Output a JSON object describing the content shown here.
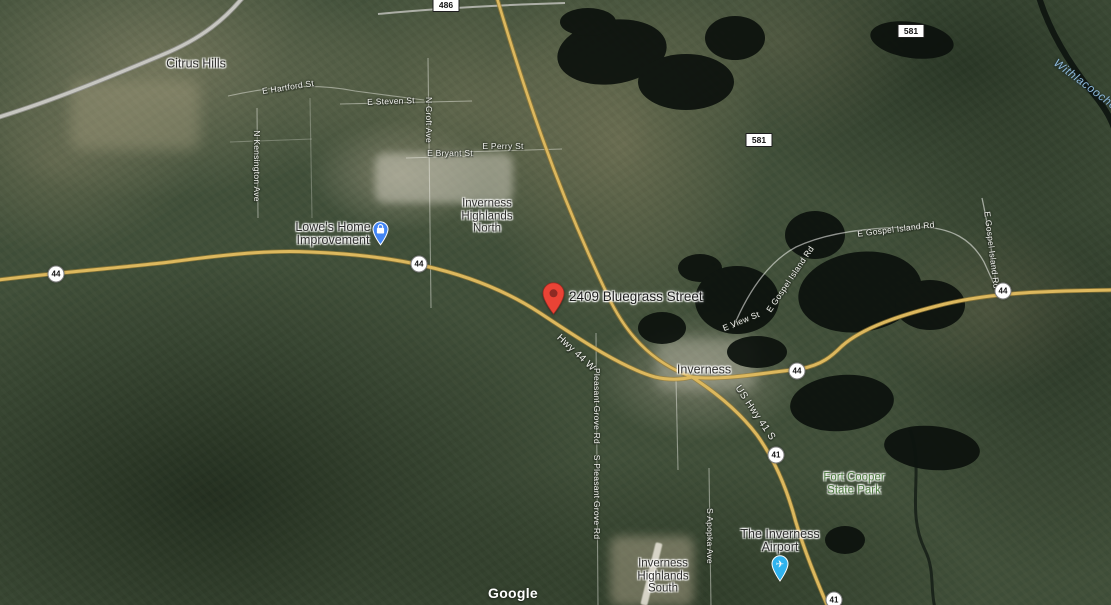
{
  "marker": {
    "title": "2409 Bluegrass Street",
    "icon": "red-map-pin-icon",
    "color": "#EA4335"
  },
  "places": {
    "citrus_hills": {
      "label": "Citrus Hills"
    },
    "inverness_highlands_north": {
      "line1": "Inverness",
      "line2": "Highlands",
      "line3": "North"
    },
    "inverness": {
      "label": "Inverness"
    },
    "inverness_highlands_south": {
      "line1": "Inverness",
      "line2": "Highlands",
      "line3": "South"
    },
    "fort_cooper": {
      "line1": "Fort Cooper",
      "line2": "State Park",
      "color": "#4C7C3F"
    }
  },
  "pois": {
    "lowes": {
      "line1": "Lowe's Home",
      "line2": "Improvement",
      "icon": "shopping-bag-pin-icon",
      "color": "#4285F4"
    },
    "airport": {
      "line1": "The Inverness",
      "line2": "Airport",
      "icon": "airplane-pin-icon",
      "color": "#2FB3EF"
    }
  },
  "streets": {
    "e_hartford": "E Hartford St",
    "e_steven": "E Steven St",
    "n_croft": "N Croft Ave",
    "e_bryant": "E Bryant St",
    "e_perry": "E Perry St",
    "n_kensington": "N Kensington Ave",
    "hwy_44_w": "Hwy 44 W",
    "us_hwy_41_s": "US Hwy 41 S",
    "pleasant_grove": "Pleasant Grove Rd",
    "s_pleasant_grove": "S Pleasant Grove Rd",
    "s_apopka": "S Apopka Ave",
    "e_view": "E View St",
    "e_gospel_island_a": "E Gospel Island Rd",
    "e_gospel_island_b": "E Gospel Island Rd",
    "e_gospel_island_c": "E Gospel Island Rd"
  },
  "water": {
    "withlacoochee": "Withlacoochee"
  },
  "shields": {
    "s486": "486",
    "s581a": "581",
    "s581b": "581",
    "c44a": "44",
    "c44b": "44",
    "c44c": "44",
    "c44d": "44",
    "c41a": "41",
    "c41b": "41"
  },
  "attribution": {
    "logo": "Google"
  },
  "colors": {
    "highway_road": "#DCB85E",
    "minor_road": "#C6C6C0",
    "water": "#0C120D",
    "terrain_base": "#41503A"
  }
}
